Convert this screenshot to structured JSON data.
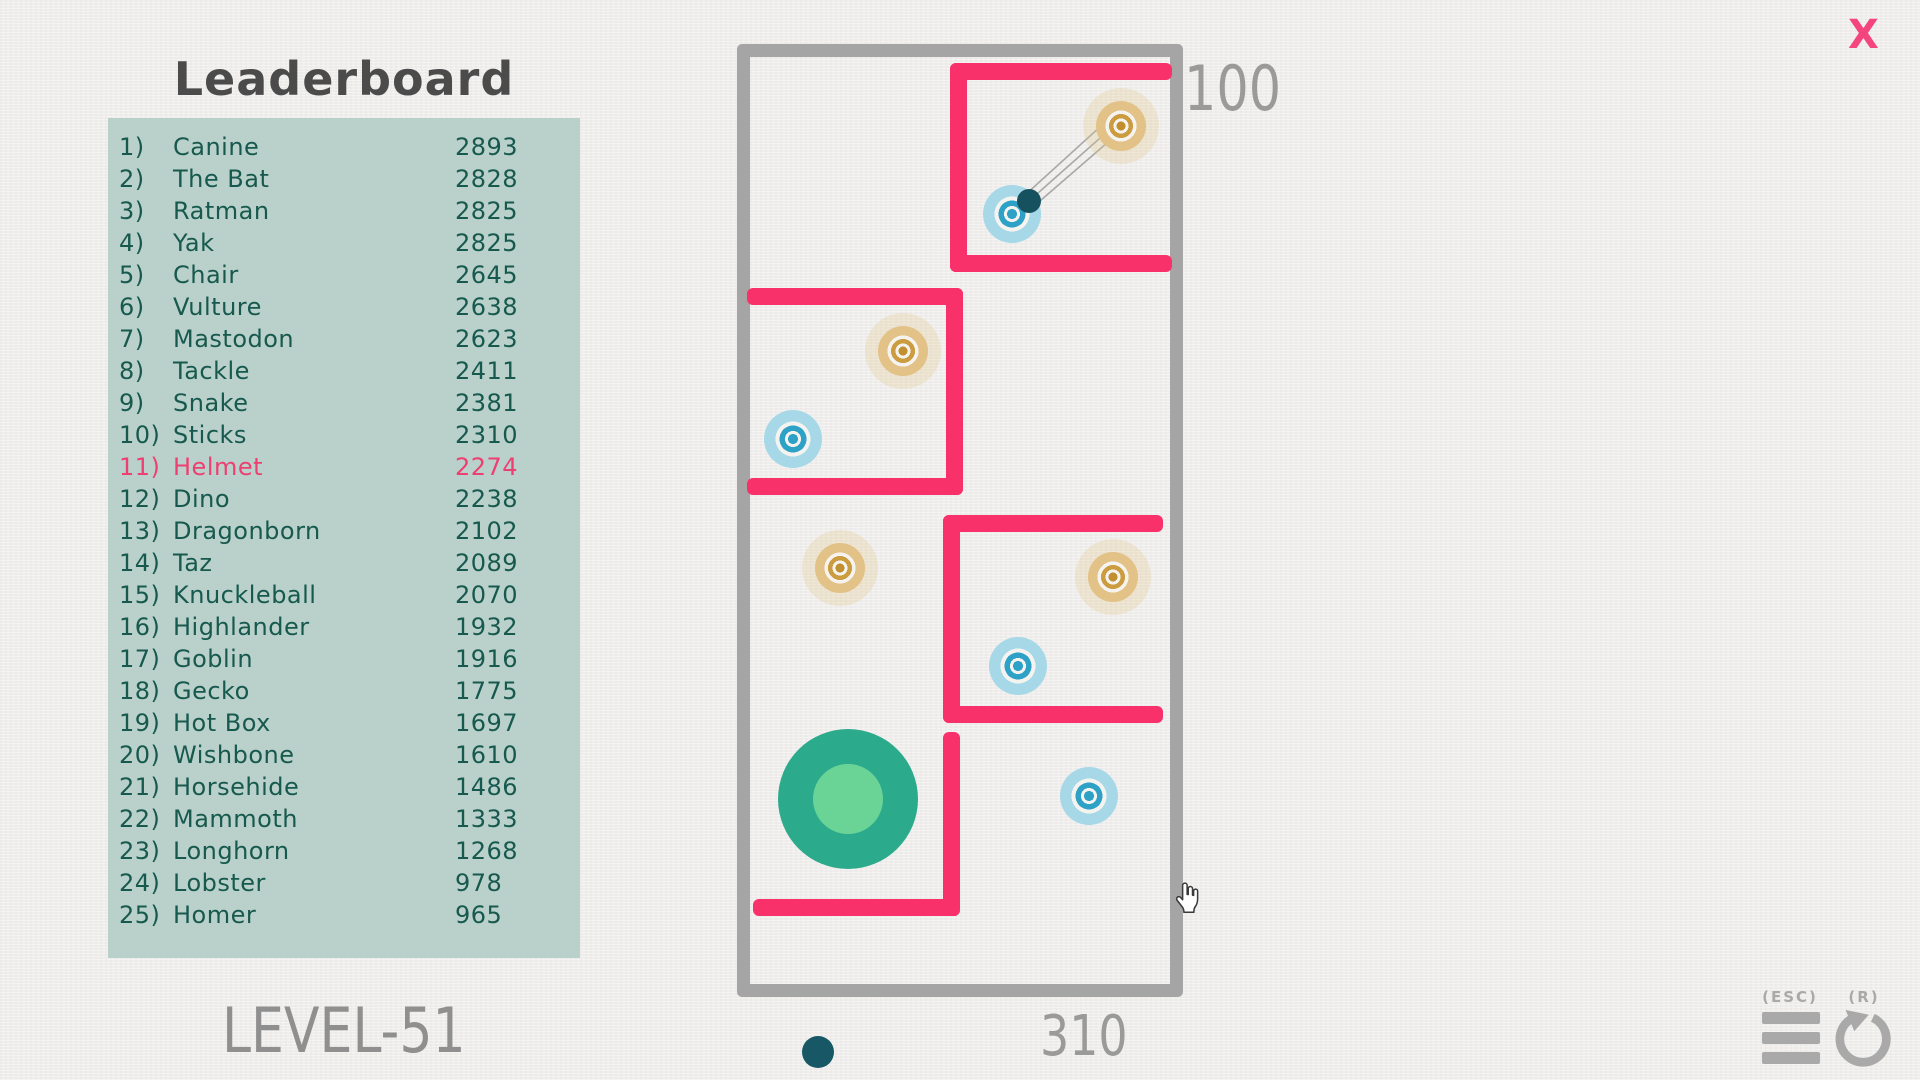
{
  "title": "Leaderboard",
  "level_label": "LEVEL-51",
  "close_label": "X",
  "hud": {
    "top_score": "100",
    "bottom_score": "310"
  },
  "controls": {
    "menu_key": "(ESC)",
    "restart_key": "(R)"
  },
  "leaderboard": {
    "entries": [
      {
        "rank": "1)",
        "name": "Canine",
        "score": "2893",
        "highlight": false
      },
      {
        "rank": "2)",
        "name": "The Bat",
        "score": "2828",
        "highlight": false
      },
      {
        "rank": "3)",
        "name": "Ratman",
        "score": "2825",
        "highlight": false
      },
      {
        "rank": "4)",
        "name": "Yak",
        "score": "2825",
        "highlight": false
      },
      {
        "rank": "5)",
        "name": "Chair",
        "score": "2645",
        "highlight": false
      },
      {
        "rank": "6)",
        "name": "Vulture",
        "score": "2638",
        "highlight": false
      },
      {
        "rank": "7)",
        "name": "Mastodon",
        "score": "2623",
        "highlight": false
      },
      {
        "rank": "8)",
        "name": "Tackle",
        "score": "2411",
        "highlight": false
      },
      {
        "rank": "9)",
        "name": "Snake",
        "score": "2381",
        "highlight": false
      },
      {
        "rank": "10)",
        "name": "Sticks",
        "score": "2310",
        "highlight": false
      },
      {
        "rank": "11)",
        "name": "Helmet",
        "score": "2274",
        "highlight": true
      },
      {
        "rank": "12)",
        "name": "Dino",
        "score": "2238",
        "highlight": false
      },
      {
        "rank": "13)",
        "name": "Dragonborn",
        "score": "2102",
        "highlight": false
      },
      {
        "rank": "14)",
        "name": "Taz",
        "score": "2089",
        "highlight": false
      },
      {
        "rank": "15)",
        "name": "Knuckleball",
        "score": "2070",
        "highlight": false
      },
      {
        "rank": "16)",
        "name": "Highlander",
        "score": "1932",
        "highlight": false
      },
      {
        "rank": "17)",
        "name": "Goblin",
        "score": "1916",
        "highlight": false
      },
      {
        "rank": "18)",
        "name": "Gecko",
        "score": "1775",
        "highlight": false
      },
      {
        "rank": "19)",
        "name": "Hot Box",
        "score": "1697",
        "highlight": false
      },
      {
        "rank": "20)",
        "name": "Wishbone",
        "score": "1610",
        "highlight": false
      },
      {
        "rank": "21)",
        "name": "Horsehide",
        "score": "1486",
        "highlight": false
      },
      {
        "rank": "22)",
        "name": "Mammoth",
        "score": "1333",
        "highlight": false
      },
      {
        "rank": "23)",
        "name": "Longhorn",
        "score": "1268",
        "highlight": false
      },
      {
        "rank": "24)",
        "name": "Lobster",
        "score": "978",
        "highlight": false
      },
      {
        "rank": "25)",
        "name": "Homer",
        "score": "965",
        "highlight": false
      }
    ]
  },
  "board": {
    "pink_walls": [
      {
        "x": 950,
        "y": 63,
        "w": 222,
        "h": 17
      },
      {
        "x": 950,
        "y": 63,
        "w": 17,
        "h": 209
      },
      {
        "x": 950,
        "y": 255,
        "w": 222,
        "h": 17
      },
      {
        "x": 747,
        "y": 288,
        "w": 216,
        "h": 17
      },
      {
        "x": 946,
        "y": 288,
        "w": 17,
        "h": 207
      },
      {
        "x": 747,
        "y": 478,
        "w": 216,
        "h": 17
      },
      {
        "x": 943,
        "y": 515,
        "w": 220,
        "h": 17
      },
      {
        "x": 943,
        "y": 515,
        "w": 17,
        "h": 208
      },
      {
        "x": 943,
        "y": 706,
        "w": 220,
        "h": 17
      },
      {
        "x": 943,
        "y": 732,
        "w": 17,
        "h": 184
      },
      {
        "x": 753,
        "y": 899,
        "w": 207,
        "h": 17
      }
    ],
    "targets": [
      {
        "color": "orange",
        "x": 1121,
        "y": 126
      },
      {
        "color": "orange",
        "x": 903,
        "y": 351
      },
      {
        "color": "orange",
        "x": 1113,
        "y": 577
      },
      {
        "color": "orange",
        "x": 840,
        "y": 568
      },
      {
        "color": "blue",
        "x": 1012,
        "y": 214
      },
      {
        "color": "blue",
        "x": 793,
        "y": 439
      },
      {
        "color": "blue",
        "x": 1018,
        "y": 666
      },
      {
        "color": "blue",
        "x": 1089,
        "y": 796
      }
    ],
    "ball": {
      "x": 1029,
      "y": 201
    },
    "trail_lines": [
      {
        "x1": 1024,
        "y1": 196,
        "x2": 1112,
        "y2": 116
      },
      {
        "x1": 1029,
        "y1": 201,
        "x2": 1117,
        "y2": 123
      },
      {
        "x1": 1033,
        "y1": 207,
        "x2": 1122,
        "y2": 130
      }
    ],
    "start_circle": {
      "x": 848,
      "y": 799
    },
    "shot_indicator": {
      "x": 818,
      "y": 1052
    },
    "cursor": {
      "x": 1172,
      "y": 882
    }
  },
  "colors": {
    "background": "#efeeec",
    "panel": "#b9d1ca",
    "panel_text": "#17594e",
    "highlight": "#ee3f72",
    "title": "#4b4b4b",
    "wall_gray": "#a5a5a5",
    "wall_pink": "#f8316b",
    "orange_ring": "#cb9c40",
    "orange_outer": "#e3c287",
    "blue_ring": "#2ea1c7",
    "blue_outer": "#a7d8e8",
    "ball": "#16515f",
    "start_outer": "#2caa8c",
    "start_inner": "#6ad497",
    "hud_gray": "#9a9a9a",
    "close_pink": "#f4457c"
  }
}
